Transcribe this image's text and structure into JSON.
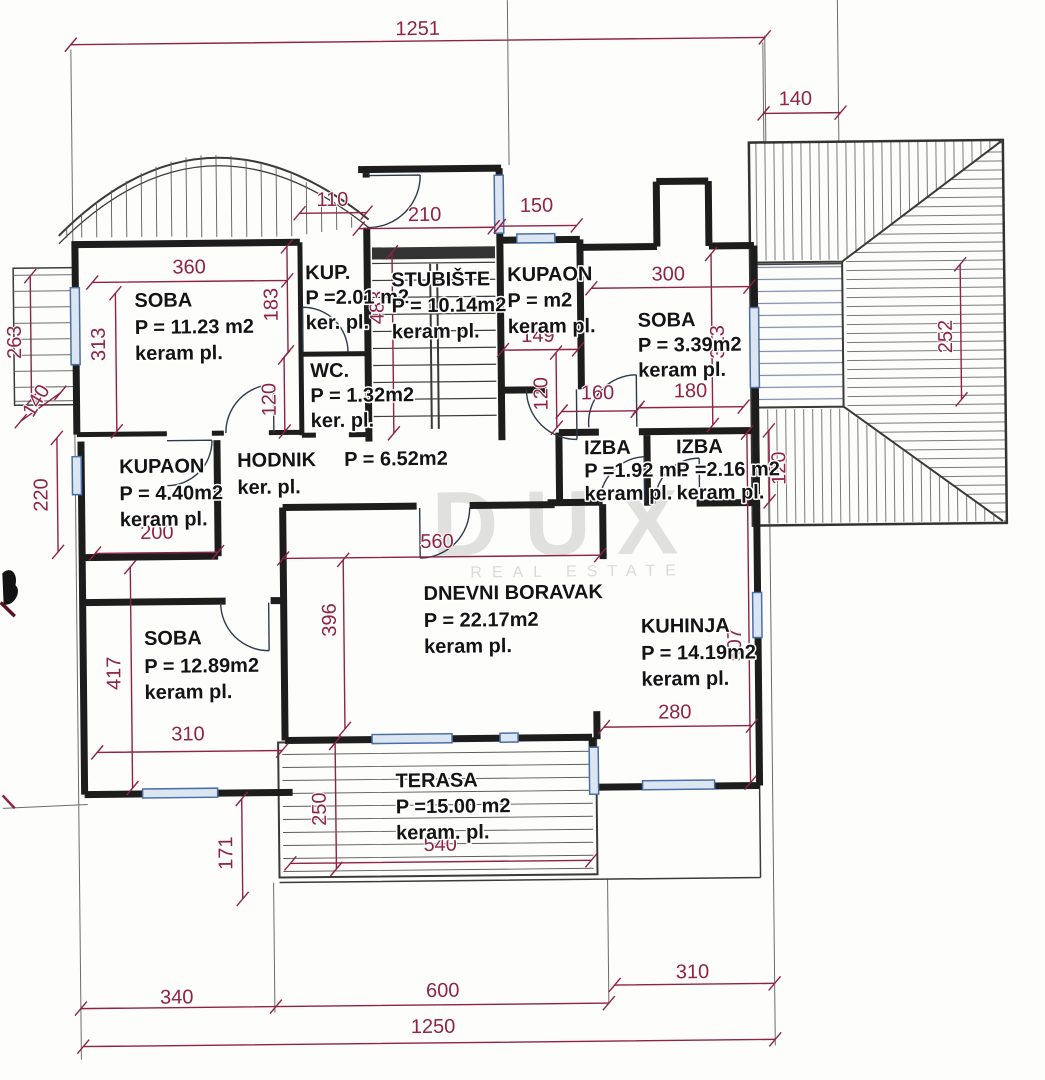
{
  "watermark": {
    "brand": "DUX",
    "tagline": "REAL ESTATE"
  },
  "colors": {
    "dim_color": "#8e2247",
    "wall_color": "#1d1d1d",
    "window_color": "#4a6fa5",
    "paper": "#fdfdfc"
  },
  "rooms": {
    "soba1": {
      "name": "SOBA",
      "area": "P = 11.23 m2",
      "floor": "keram pl."
    },
    "kup": {
      "name": "KUP.",
      "area": "P =2.01 m2",
      "floor": "ker. pl."
    },
    "wc": {
      "name": "WC.",
      "area": "P = 1.32m2",
      "floor": "ker. pl."
    },
    "stubiste": {
      "name": "STUBIŠTE",
      "area": "P = 10.14m2",
      "floor": "keram pl."
    },
    "kupaon_top": {
      "name": "KUPAON",
      "area": "P = m2",
      "floor": "keram pl."
    },
    "soba2": {
      "name": "SOBA",
      "area": "P = 3.39m2",
      "floor": "keram pl."
    },
    "izba1": {
      "name": "IZBA",
      "area": "P =1.92 m2",
      "floor": "keram pl."
    },
    "izba2": {
      "name": "IZBA",
      "area": "P =2.16 m2",
      "floor": "keram pl."
    },
    "kupaon_left": {
      "name": "KUPAON",
      "area": "P = 4.40m2",
      "floor": "keram pl."
    },
    "hodnik": {
      "name": "HODNIK",
      "area": "P = 6.52m2",
      "floor": "ker. pl."
    },
    "dnevni": {
      "name": "DNEVNI BORAVAK",
      "area": "P = 22.17m2",
      "floor": "keram pl."
    },
    "kuhinja": {
      "name": "KUHINJA",
      "area": "P = 14.19m2",
      "floor": "keram pl."
    },
    "soba3": {
      "name": "SOBA",
      "area": "P = 12.89m2",
      "floor": "keram pl."
    },
    "terasa": {
      "name": "TERASA",
      "area": "P =15.00 m2",
      "floor": "keram. pl."
    }
  },
  "dims": {
    "total_top": "1251",
    "total_bottom": "1250",
    "roof_top": "140",
    "kup_top": "110",
    "stubiste_top": "210",
    "kupaon_top_w": "150",
    "soba1_w": "360",
    "soba1_h": "313",
    "kup_h": "183",
    "wc_h": "120",
    "balcony_side": "263",
    "balcony_side_b": "140",
    "stubiste_h": "483",
    "kupaon_top_w2": "149",
    "kupaon_door": "120",
    "hall_160": "160",
    "hall_180": "180",
    "soba2_w": "300",
    "soba2_h": "313",
    "roof_h": "252",
    "izba2_h": "120",
    "kupaon_left_h": "220",
    "kupaon_left_w": "200",
    "dnevni_w": "560",
    "dnevni_h": "396",
    "kuhinja_h": "507",
    "kuhinja_w": "280",
    "soba3_h": "417",
    "soba3_w": "310",
    "terasa_h": "250",
    "terasa_w": "540",
    "terasa_step": "171",
    "bottom_left": "340",
    "bottom_mid": "600",
    "bottom_right": "310"
  }
}
